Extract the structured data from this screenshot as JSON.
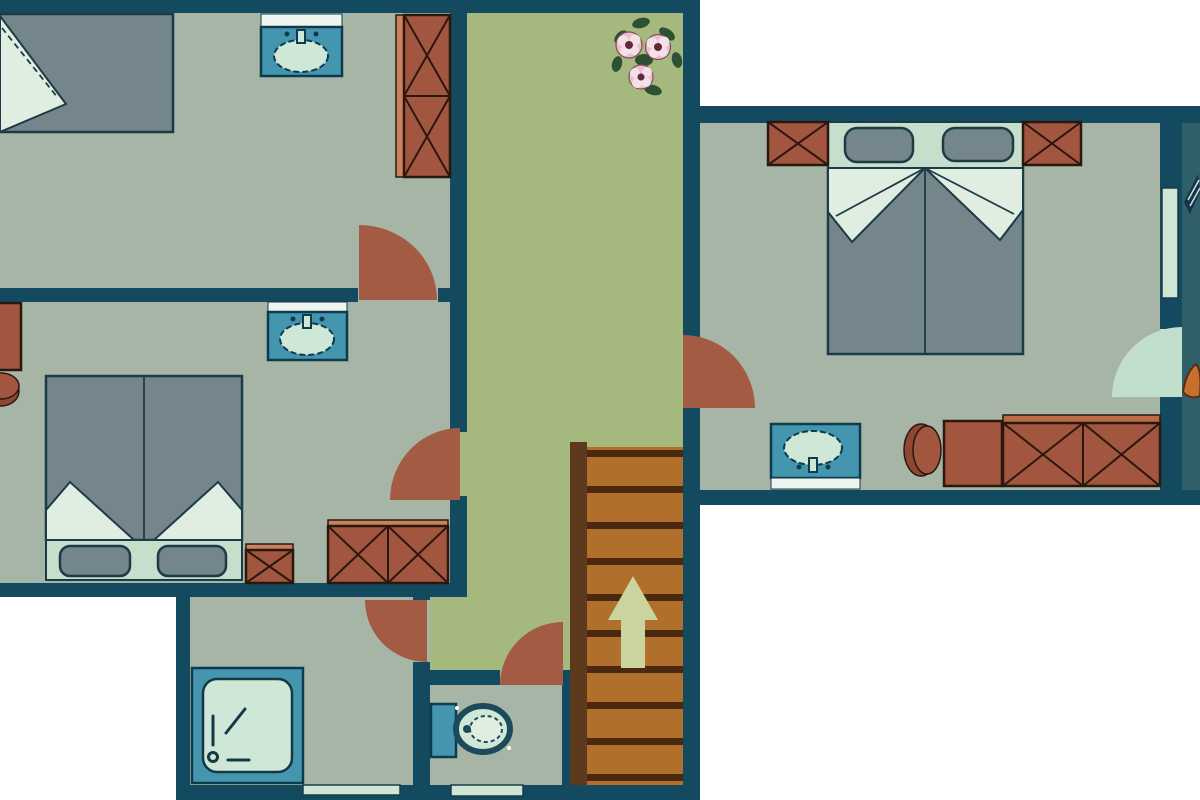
{
  "title": "upper-floor-plan",
  "colors": {
    "outside": "#ffffff",
    "wall": "#134a5f",
    "floor": "#a7b5a7",
    "hall": "#a5b97e",
    "balcony": "#2f606a",
    "door": "#a35b44",
    "paledoor": "#c2decd",
    "window": "#cfe6d4",
    "brick": "#a2553f",
    "lightwood": "#c9825d",
    "lightwood2": "#bc6c45",
    "woodline": "#2a180e",
    "slate": "#74868c",
    "bedpale": "#c5dfcc",
    "bedfold": "#dfeee0",
    "stroke": "#1d3b45",
    "fixture": "#4496ae",
    "fixstroke": "#0e3a4d",
    "basin": "#cfe7d6",
    "shelf": "#eef5ee",
    "glyph": "#143844",
    "stairs": "#b06f2a",
    "stairline": "#4b2810",
    "rail": "#5d3a1e",
    "arrow": "#c9d49e",
    "toilet": "#1d4a5a",
    "leaf": "#2c5233",
    "petal": "#e9bfcf",
    "petal2": "#f4e0e7",
    "fcenter": "#63263a",
    "flowerstroke": "#8a4a5c",
    "navyitem": "#16324e",
    "orangeitem": "#c5702e"
  },
  "scene": {
    "type": "floor-plan",
    "rooms": [
      {
        "id": "bedroom-top-left",
        "furniture": [
          "single-bed",
          "washbasin",
          "wardrobe-2door",
          "swing-door"
        ]
      },
      {
        "id": "bedroom-mid-left",
        "furniture": [
          "double-bed",
          "washbasin",
          "wardrobe",
          "wardrobe-2door",
          "stool",
          "swing-door"
        ]
      },
      {
        "id": "bedroom-right",
        "furniture": [
          "double-bed",
          "two-nightstand-wardrobes",
          "washbasin",
          "stool",
          "cabinet",
          "wardrobe-2door",
          "swing-door",
          "balcony-door",
          "window"
        ]
      },
      {
        "id": "bathroom",
        "furniture": [
          "shower",
          "swing-door",
          "bottom-window"
        ]
      },
      {
        "id": "wc",
        "furniture": [
          "toilet",
          "swing-door",
          "bottom-window"
        ]
      },
      {
        "id": "hallway",
        "furniture": [
          "staircase",
          "up-arrow",
          "flower-bouquet"
        ]
      }
    ],
    "stairs_direction": "up"
  }
}
